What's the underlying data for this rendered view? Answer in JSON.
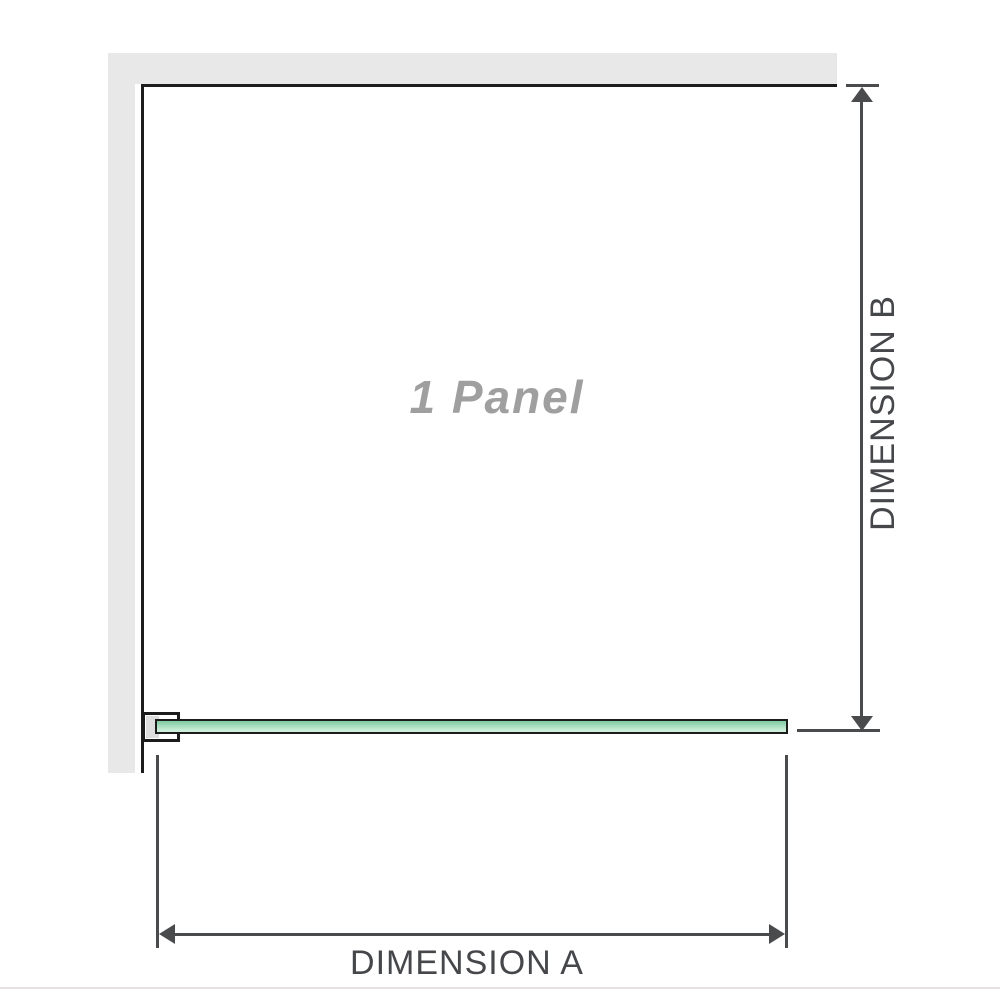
{
  "diagram": {
    "panel_label": "1 Panel",
    "dimension_a_label": "DIMENSION A",
    "dimension_b_label": "DIMENSION B",
    "colors": {
      "wall": "#e8e8e8",
      "panel_border": "#1c1c1c",
      "glass_top": "#7ecba0",
      "glass_bottom": "#cdeeda",
      "glass_outline": "#1c1c1c",
      "dimension_line": "#4a4b4d",
      "label_text": "#45474a",
      "panel_label_text": "#9f9f9f",
      "baseline": "#e7e0e0"
    }
  }
}
